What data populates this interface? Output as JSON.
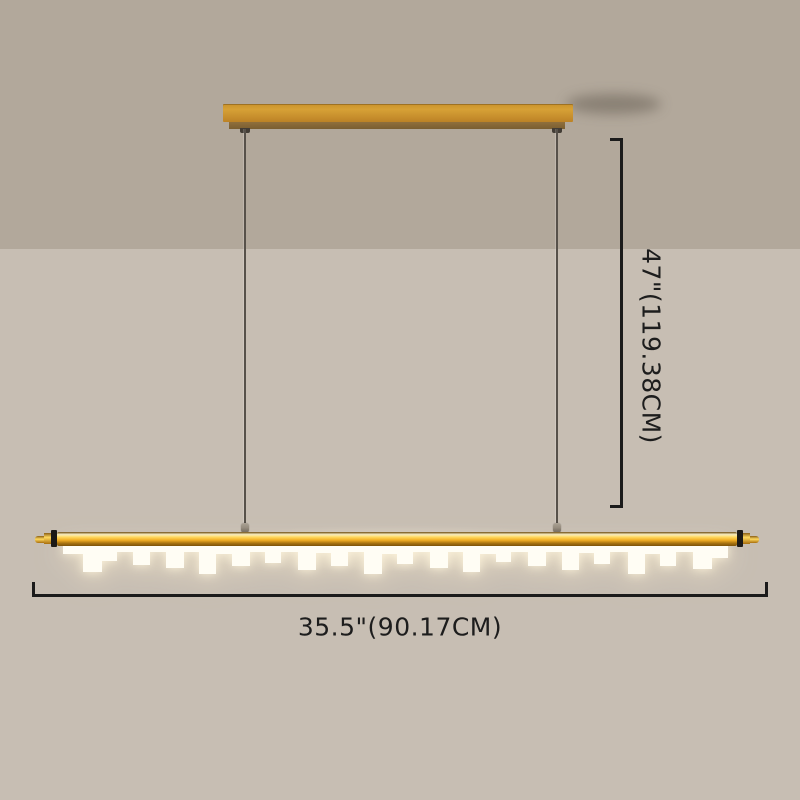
{
  "scene": {
    "description_labels": {
      "height_label": "47\"(119.38CM)",
      "width_label": "35.5\"(90.17CM)"
    }
  },
  "colors": {
    "wall-upper": "#b2a89b",
    "wall-lower": "#c7beb3",
    "canopy-gold-light": "#d7a136",
    "canopy-gold-dark": "#bc8226",
    "canopy-underside": "#8f6f3c",
    "gold-edge": "#6d4c12",
    "gold-highlight": "#f9efc2",
    "gold-bright": "#ffd95e",
    "gold-mid": "#f2ae24",
    "gold-deep": "#a97310",
    "gold-shadow": "#7c5208",
    "cap-black": "#1c1a17",
    "wire": "#57514a",
    "bead": "#968c7f",
    "dim-line": "#1b1b1b",
    "dim-text": "#1d1d1d",
    "diffuser": "#fffdf4"
  },
  "skyline": {
    "height": 36,
    "segments": [
      [
        20,
        10
      ],
      [
        19,
        28
      ],
      [
        15,
        17
      ],
      [
        16,
        8
      ],
      [
        17,
        21
      ],
      [
        16,
        8
      ],
      [
        18,
        24
      ],
      [
        15,
        8
      ],
      [
        17,
        30
      ],
      [
        16,
        10
      ],
      [
        18,
        22
      ],
      [
        15,
        8
      ],
      [
        16,
        19
      ],
      [
        17,
        8
      ],
      [
        18,
        26
      ],
      [
        15,
        9
      ],
      [
        17,
        22
      ],
      [
        16,
        8
      ],
      [
        18,
        30
      ],
      [
        15,
        10
      ],
      [
        16,
        20
      ],
      [
        17,
        8
      ],
      [
        18,
        24
      ],
      [
        15,
        8
      ],
      [
        17,
        28
      ],
      [
        16,
        10
      ],
      [
        15,
        18
      ],
      [
        17,
        8
      ],
      [
        18,
        22
      ],
      [
        16,
        8
      ],
      [
        17,
        26
      ],
      [
        15,
        9
      ],
      [
        16,
        20
      ],
      [
        18,
        8
      ],
      [
        17,
        30
      ],
      [
        15,
        10
      ],
      [
        16,
        22
      ],
      [
        17,
        8
      ],
      [
        19,
        25
      ],
      [
        16,
        14
      ]
    ]
  }
}
